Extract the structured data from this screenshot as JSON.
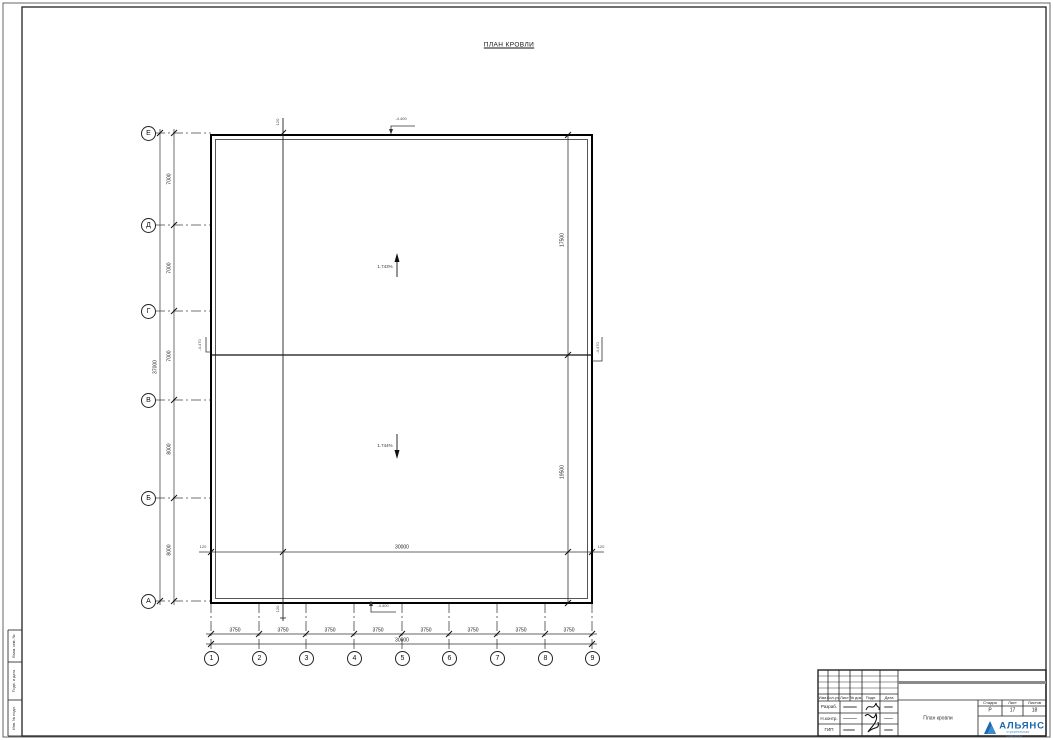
{
  "drawing": {
    "title": "ПЛАН КРОВЛИ",
    "row_axes": [
      "Е",
      "Д",
      "Г",
      "В",
      "Б",
      "А"
    ],
    "row_dims": [
      "7000",
      "7000",
      "7000",
      "8000",
      "8000"
    ],
    "row_total": "37000",
    "col_axes": [
      "1",
      "2",
      "3",
      "4",
      "5",
      "6",
      "7",
      "8",
      "9"
    ],
    "col_dims": [
      "3750",
      "3750",
      "3750",
      "3750",
      "3750",
      "3750",
      "3750",
      "3750"
    ],
    "col_total": "30000",
    "inner_width_total": "30000",
    "inner_offset_left": "120",
    "inner_offset_right": "120",
    "top_edge_offset": "120",
    "bottom_edge_offset": "120",
    "right_span_upper": "17500",
    "right_span_lower": "19500",
    "slope_upper": "1.743%",
    "slope_lower": "1.744%",
    "elev_mark_top": "-4.400",
    "elev_mark_bottom": "-4.400",
    "elev_mark_ridge_left": "-4.470",
    "elev_mark_ridge_right": "-4.470"
  },
  "margin": {
    "boxes": [
      "Взам. инв. №",
      "Подп. и дата",
      "Инв. № подл."
    ]
  },
  "titleblock": {
    "rev_headers": [
      "Изм.",
      "Кол.уч.",
      "Лист",
      "№ док.",
      "Подп.",
      "Дата"
    ],
    "sign_rows": [
      {
        "role": "Разраб."
      },
      {
        "role": "Н.контр."
      },
      {
        "role": "ГИП"
      }
    ],
    "stage_label": "Стадия",
    "sheet_label": "Лист",
    "sheets_label": "Листов",
    "stage": "Р",
    "sheet": "17",
    "sheets": "18",
    "doc_title": "План кровли",
    "company": "АЛЬЯНС",
    "company_sub": "строительная компания",
    "logo_color": "#1a67b0"
  }
}
